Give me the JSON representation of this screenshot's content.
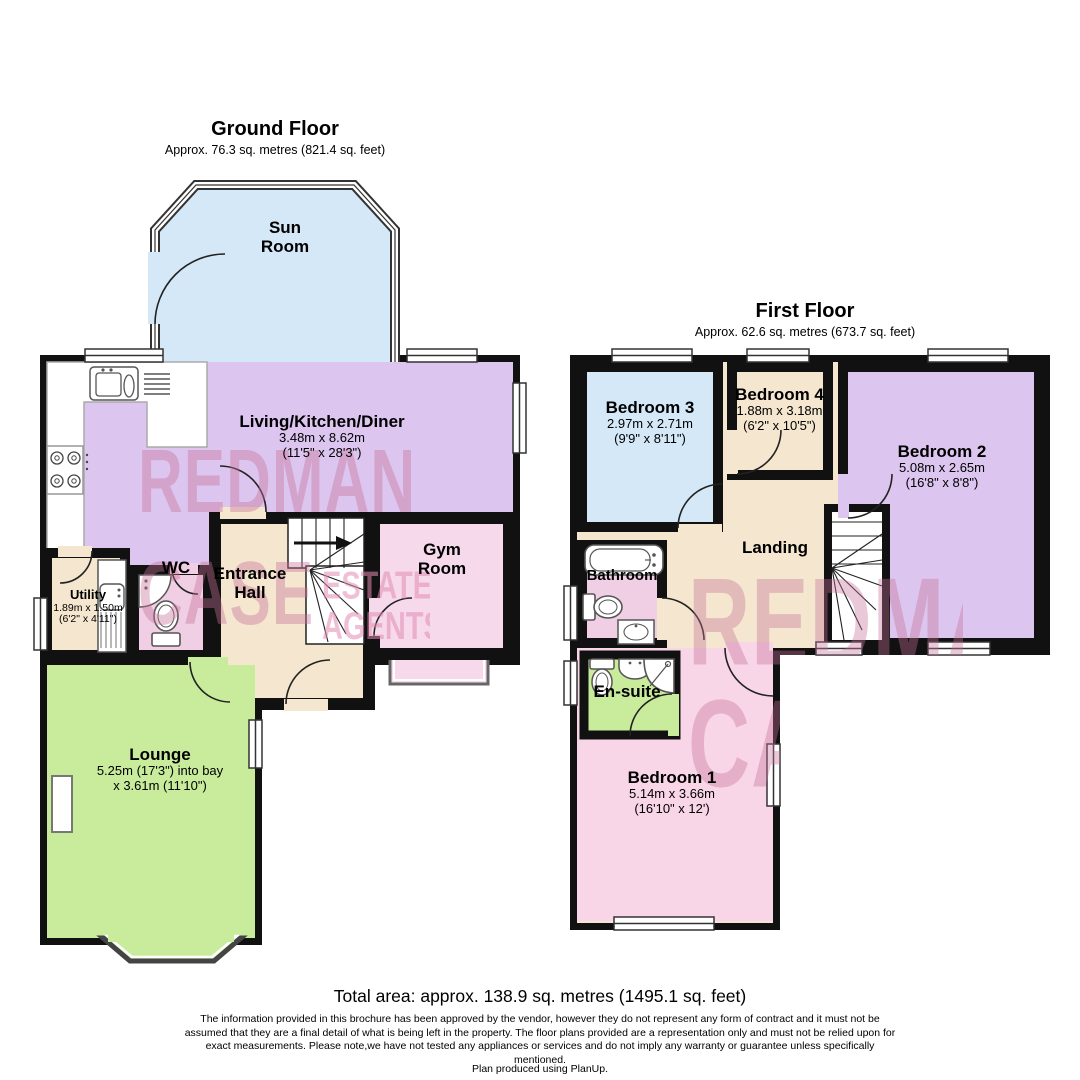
{
  "ground_floor": {
    "title": "Ground Floor",
    "subtitle": "Approx. 76.3 sq. metres (821.4 sq. feet)",
    "rooms": {
      "sun_room": {
        "name": "Sun\nRoom"
      },
      "living_kitchen_diner": {
        "name": "Living/Kitchen/Diner",
        "dims_m": "3.48m x 8.62m",
        "dims_ft": "(11'5\" x 28'3\")"
      },
      "utility": {
        "name": "Utility",
        "dims_m": "1.89m x 1.50m",
        "dims_ft": "(6'2\" x 4'11\")"
      },
      "wc": {
        "name": "WC"
      },
      "entrance_hall": {
        "name": "Entrance\nHall"
      },
      "gym_room": {
        "name": "Gym\nRoom"
      },
      "lounge": {
        "name": "Lounge",
        "dims_m": "5.25m (17'3\") into bay",
        "dims_ft": "x 3.61m (11'10\")"
      }
    }
  },
  "first_floor": {
    "title": "First Floor",
    "subtitle": "Approx. 62.6 sq. metres (673.7 sq. feet)",
    "rooms": {
      "bedroom_3": {
        "name": "Bedroom 3",
        "dims_m": "2.97m x 2.71m",
        "dims_ft": "(9'9\" x 8'11\")"
      },
      "bedroom_4": {
        "name": "Bedroom 4",
        "dims_m": "1.88m x 3.18m",
        "dims_ft": "(6'2\" x 10'5\")"
      },
      "bedroom_2": {
        "name": "Bedroom 2",
        "dims_m": "5.08m x 2.65m",
        "dims_ft": "(16'8\" x 8'8\")"
      },
      "bathroom": {
        "name": "Bathroom"
      },
      "landing": {
        "name": "Landing"
      },
      "en_suite": {
        "name": "En-suite"
      },
      "bedroom_1": {
        "name": "Bedroom 1",
        "dims_m": "5.14m x 3.66m",
        "dims_ft": "(16'10\" x 12')"
      }
    }
  },
  "watermark": {
    "line1": "REDMAN",
    "line2": "CASE",
    "side1": "ESTATE",
    "side2": "AGENTS"
  },
  "footer": {
    "total_area": "Total area: approx. 138.9 sq. metres (1495.1 sq. feet)",
    "disclaimer": "The information provided in this brochure has been approved by the vendor, however they do not represent any form of contract and it must not be assumed that they are a final detail of what is being left in the property. The floor plans provided are a representation only and must not be relied upon for exact measurements. Please note,we have not tested any appliances or services and do not imply any warranty or guarantee unless specifically mentioned.",
    "produced": "Plan produced using PlanUp."
  },
  "colors": {
    "wall": "#111111",
    "sun_room_blue": "#d4e8f7",
    "purple": "#dcc5ee",
    "pink": "#f0cfe4",
    "light_pink": "#f6d9ea",
    "bedroom1_pink": "#f8d6e8",
    "green": "#c9ec9c",
    "cream": "#f5e7cf",
    "watermark_big": "rgba(197,112,152,0.40)",
    "watermark_small": "rgba(226,140,178,0.55)"
  }
}
